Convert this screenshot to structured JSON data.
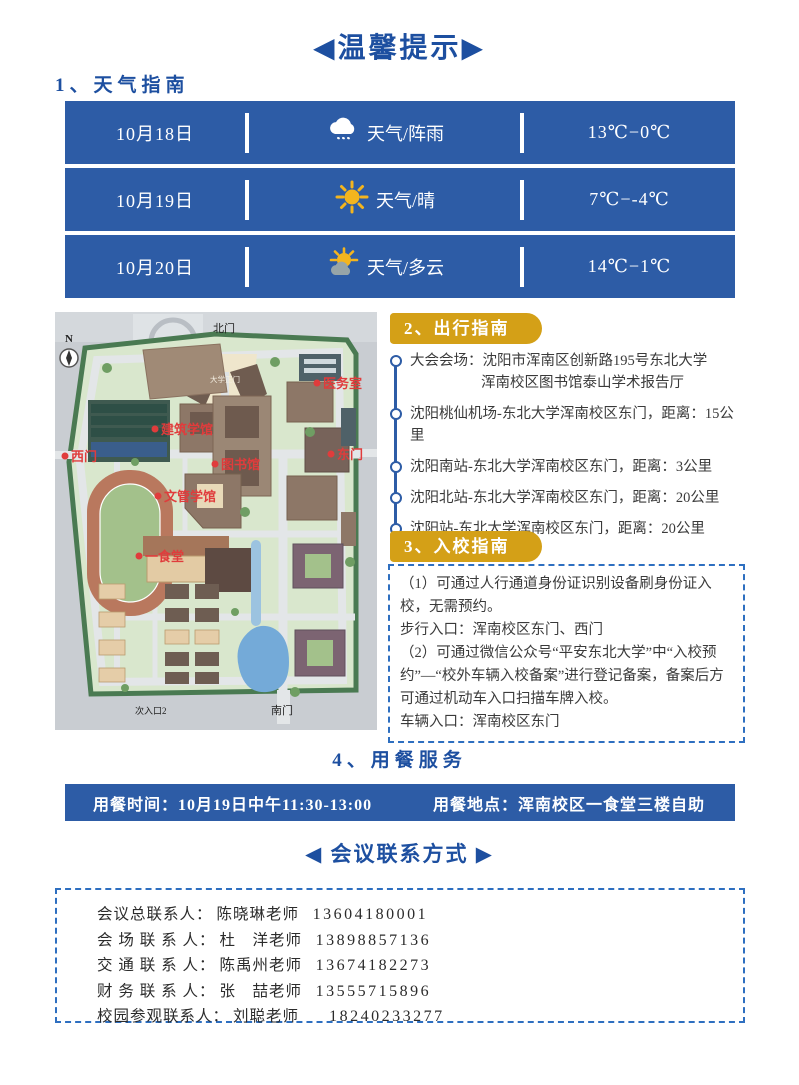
{
  "title": "◀温馨提示▶",
  "weather": {
    "heading": "1、天气指南",
    "days": [
      {
        "date": "10月18日",
        "icon": "rain-cloud-icon",
        "desc": "天气/阵雨",
        "temp": "13℃−0℃"
      },
      {
        "date": "10月19日",
        "icon": "sun-icon",
        "desc": "天气/晴",
        "temp": "7℃−-4℃"
      },
      {
        "date": "10月20日",
        "icon": "sun-cloud-icon",
        "desc": "天气/多云",
        "temp": "14℃−1℃"
      }
    ]
  },
  "map": {
    "compass_label": "N",
    "gates": {
      "north": "北门",
      "main": "大学正门",
      "south": "南门",
      "side_entrance": "次入口2"
    },
    "labels": [
      {
        "text": "医务室"
      },
      {
        "text": "建筑学馆"
      },
      {
        "text": "西门"
      },
      {
        "text": "图书馆"
      },
      {
        "text": "东门"
      },
      {
        "text": "文管学馆"
      },
      {
        "text": "一食堂"
      }
    ]
  },
  "travel": {
    "heading": "2、出行指南",
    "items": [
      {
        "text": "大会会场：沈阳市浑南区创新路195号东北大学",
        "text2": "浑南校区图书馆泰山学术报告厅"
      },
      {
        "text": "沈阳桃仙机场-东北大学浑南校区东门，距离：15公里"
      },
      {
        "text": "沈阳南站-东北大学浑南校区东门，距离：3公里"
      },
      {
        "text": "沈阳北站-东北大学浑南校区东门，距离：20公里"
      },
      {
        "text": "沈阳站-东北大学浑南校区东门，距离：20公里"
      }
    ]
  },
  "entry": {
    "heading": "3、入校指南",
    "lines": [
      "（1）可通过人行通道身份证识别设备刷身份证入校，无需预约。",
      "步行入口：浑南校区东门、西门",
      "（2）可通过微信公众号“平安东北大学”中“入校预约”—“校外车辆入校备案”进行登记备案，备案后方可通过机动车入口扫描车牌入校。",
      "车辆入口：浑南校区东门"
    ]
  },
  "dining": {
    "heading": "4、用餐服务",
    "time_label": "用餐时间：10月19日中午11:30-13:00",
    "place_label": "用餐地点：浑南校区一食堂三楼自助"
  },
  "contacts": {
    "title": "◀ 会议联系方式 ▶",
    "items": [
      {
        "role": "会议总联系人：",
        "name": "陈晓琳老师",
        "phone": "13604180001"
      },
      {
        "role": "会 场 联 系 人：",
        "name": "杜　洋老师",
        "phone": "13898857136"
      },
      {
        "role": "交 通 联 系 人：",
        "name": "陈禹州老师",
        "phone": "13674182273"
      },
      {
        "role": "财 务 联 系 人：",
        "name": "张　喆老师",
        "phone": "13555715896"
      },
      {
        "role": "校园参观联系人：",
        "name": "刘聪老师",
        "phone": "18240233277"
      }
    ]
  },
  "colors": {
    "primary_blue": "#2d5ca6",
    "heading_blue": "#1d4fa0",
    "badge_gold": "#d4a017",
    "map_label_red": "#e03c3c"
  }
}
